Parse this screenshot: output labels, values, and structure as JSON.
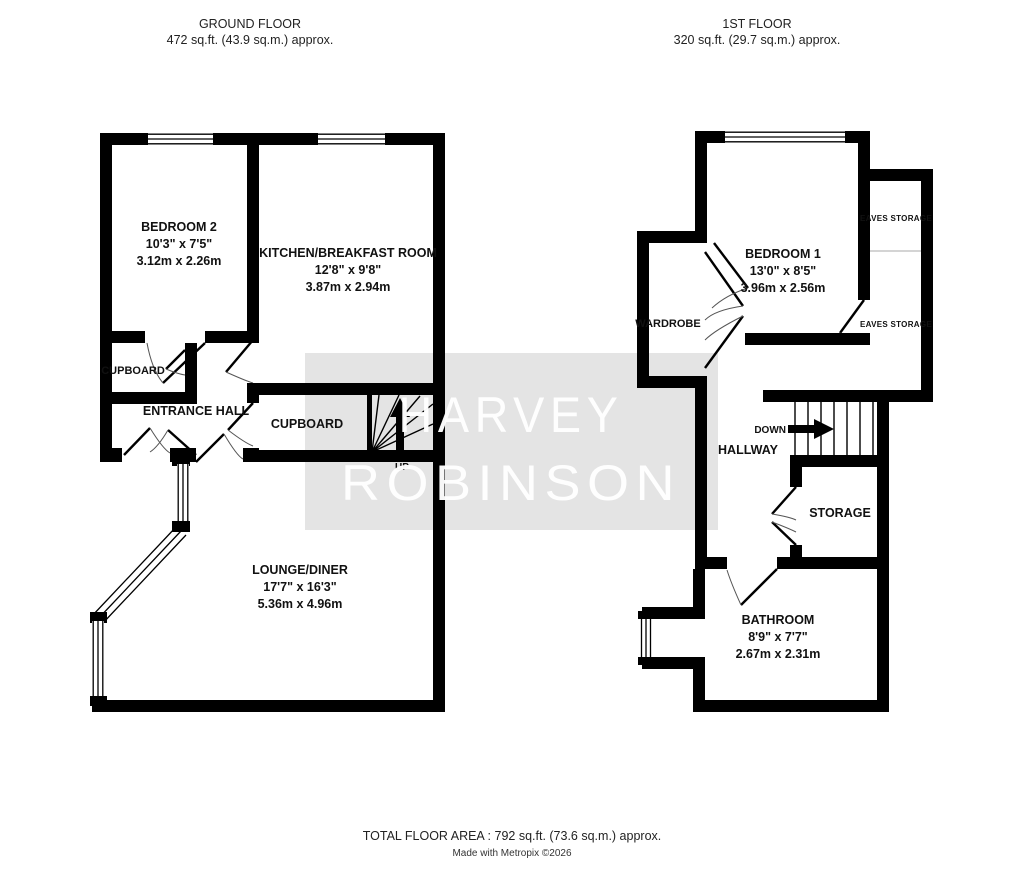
{
  "header": {
    "ground": {
      "title": "GROUND FLOOR",
      "area": "472 sq.ft. (43.9 sq.m.) approx."
    },
    "first": {
      "title": "1ST FLOOR",
      "area": "320 sq.ft. (29.7 sq.m.) approx."
    }
  },
  "ground_floor": {
    "bedroom2": {
      "name": "BEDROOM 2",
      "dims_imperial": "10'3\"  x 7'5\"",
      "dims_metric": "3.12m  x 2.26m"
    },
    "kitchen": {
      "name": "KITCHEN/BREAKFAST ROOM",
      "dims_imperial": "12'8\"  x 9'8\"",
      "dims_metric": "3.87m  x 2.94m"
    },
    "cupboard_left": {
      "name": "CUPBOARD"
    },
    "entrance_hall": {
      "name": "ENTRANCE HALL"
    },
    "cupboard_center": {
      "name": "CUPBOARD"
    },
    "lounge": {
      "name": "LOUNGE/DINER",
      "dims_imperial": "17'7\"  x 16'3\"",
      "dims_metric": "5.36m  x 4.96m"
    },
    "stairs": {
      "label": "UP"
    }
  },
  "first_floor": {
    "bedroom1": {
      "name": "BEDROOM 1",
      "dims_imperial": "13'0\"  x 8'5\"",
      "dims_metric": "3.96m  x 2.56m"
    },
    "wardrobe": {
      "name": "WARDROBE"
    },
    "eaves_top": {
      "name": "EAVES STORAGE"
    },
    "eaves_bottom": {
      "name": "EAVES STORAGE"
    },
    "hallway": {
      "name": "HALLWAY"
    },
    "stairs": {
      "label": "DOWN"
    },
    "storage": {
      "name": "STORAGE"
    },
    "bathroom": {
      "name": "BATHROOM",
      "dims_imperial": "8'9\"  x 7'7\"",
      "dims_metric": "2.67m  x 2.31m"
    }
  },
  "watermark": {
    "line1": "HARVEY",
    "line2": "ROBINSON"
  },
  "footer": {
    "total": "TOTAL FLOOR AREA : 792 sq.ft. (73.6 sq.m.) approx.",
    "credit": "Made with Metropix ©2026"
  },
  "colors": {
    "wall": "#000000",
    "watermark_bg": "#e4e4e4",
    "watermark_text": "#ffffff"
  }
}
